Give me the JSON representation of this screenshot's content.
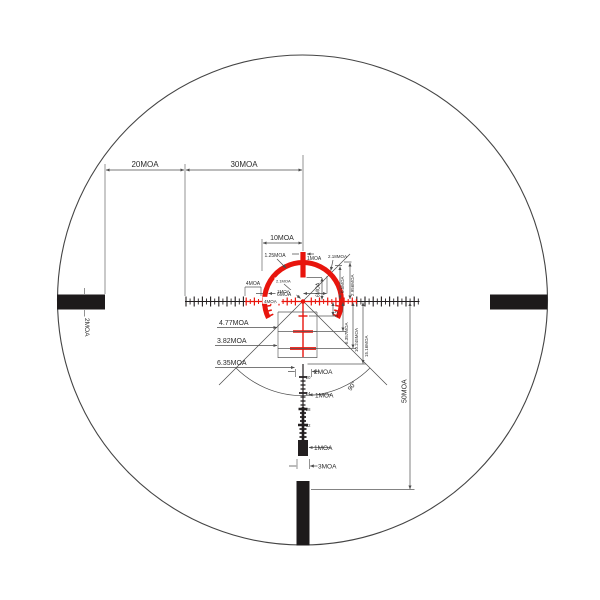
{
  "diagram": {
    "type": "rifle-scope-reticle-dimension-diagram",
    "colors": {
      "reticle_red": "#e8150d",
      "reticle_black": "#231f20",
      "dimension_gray": "#4d4d4d",
      "background": "#ffffff"
    },
    "annotations": {
      "moa20": "20MOA",
      "moa30": "30MOA",
      "moa10": "10MOA",
      "moa125": "1.25MOA",
      "moa1_top": "1MOA",
      "moa218": "2.18MOA",
      "moa05": "0.5MOA",
      "moa2956": "2.956MOA",
      "moa4_bracket": "4MOA",
      "moa1_left": "1MOA",
      "moa4_left": "4MOA",
      "moa21_center": "2.1MOA",
      "moa6_h": "6MOA",
      "moa6_v": "6MOA",
      "moa477": "4.77MOA",
      "moa382": "3.82MOA",
      "moa635_left": "6.35MOA",
      "moa22": "2.2",
      "moa6357": "6.357MOA",
      "moa10245": "10.245MOA",
      "moa1516": "15.16MOA",
      "moa2_ladder": "2MOA",
      "moa1_ladder": "1MOA",
      "tick20": "20",
      "tick24": "24",
      "tick28": "28",
      "tick32": "32",
      "angle90": "90°",
      "moa50": "50MOA",
      "moa1_bottom": "1MOA",
      "moa3_bottom": "3MOA",
      "moa2_post": "2MOA"
    }
  }
}
